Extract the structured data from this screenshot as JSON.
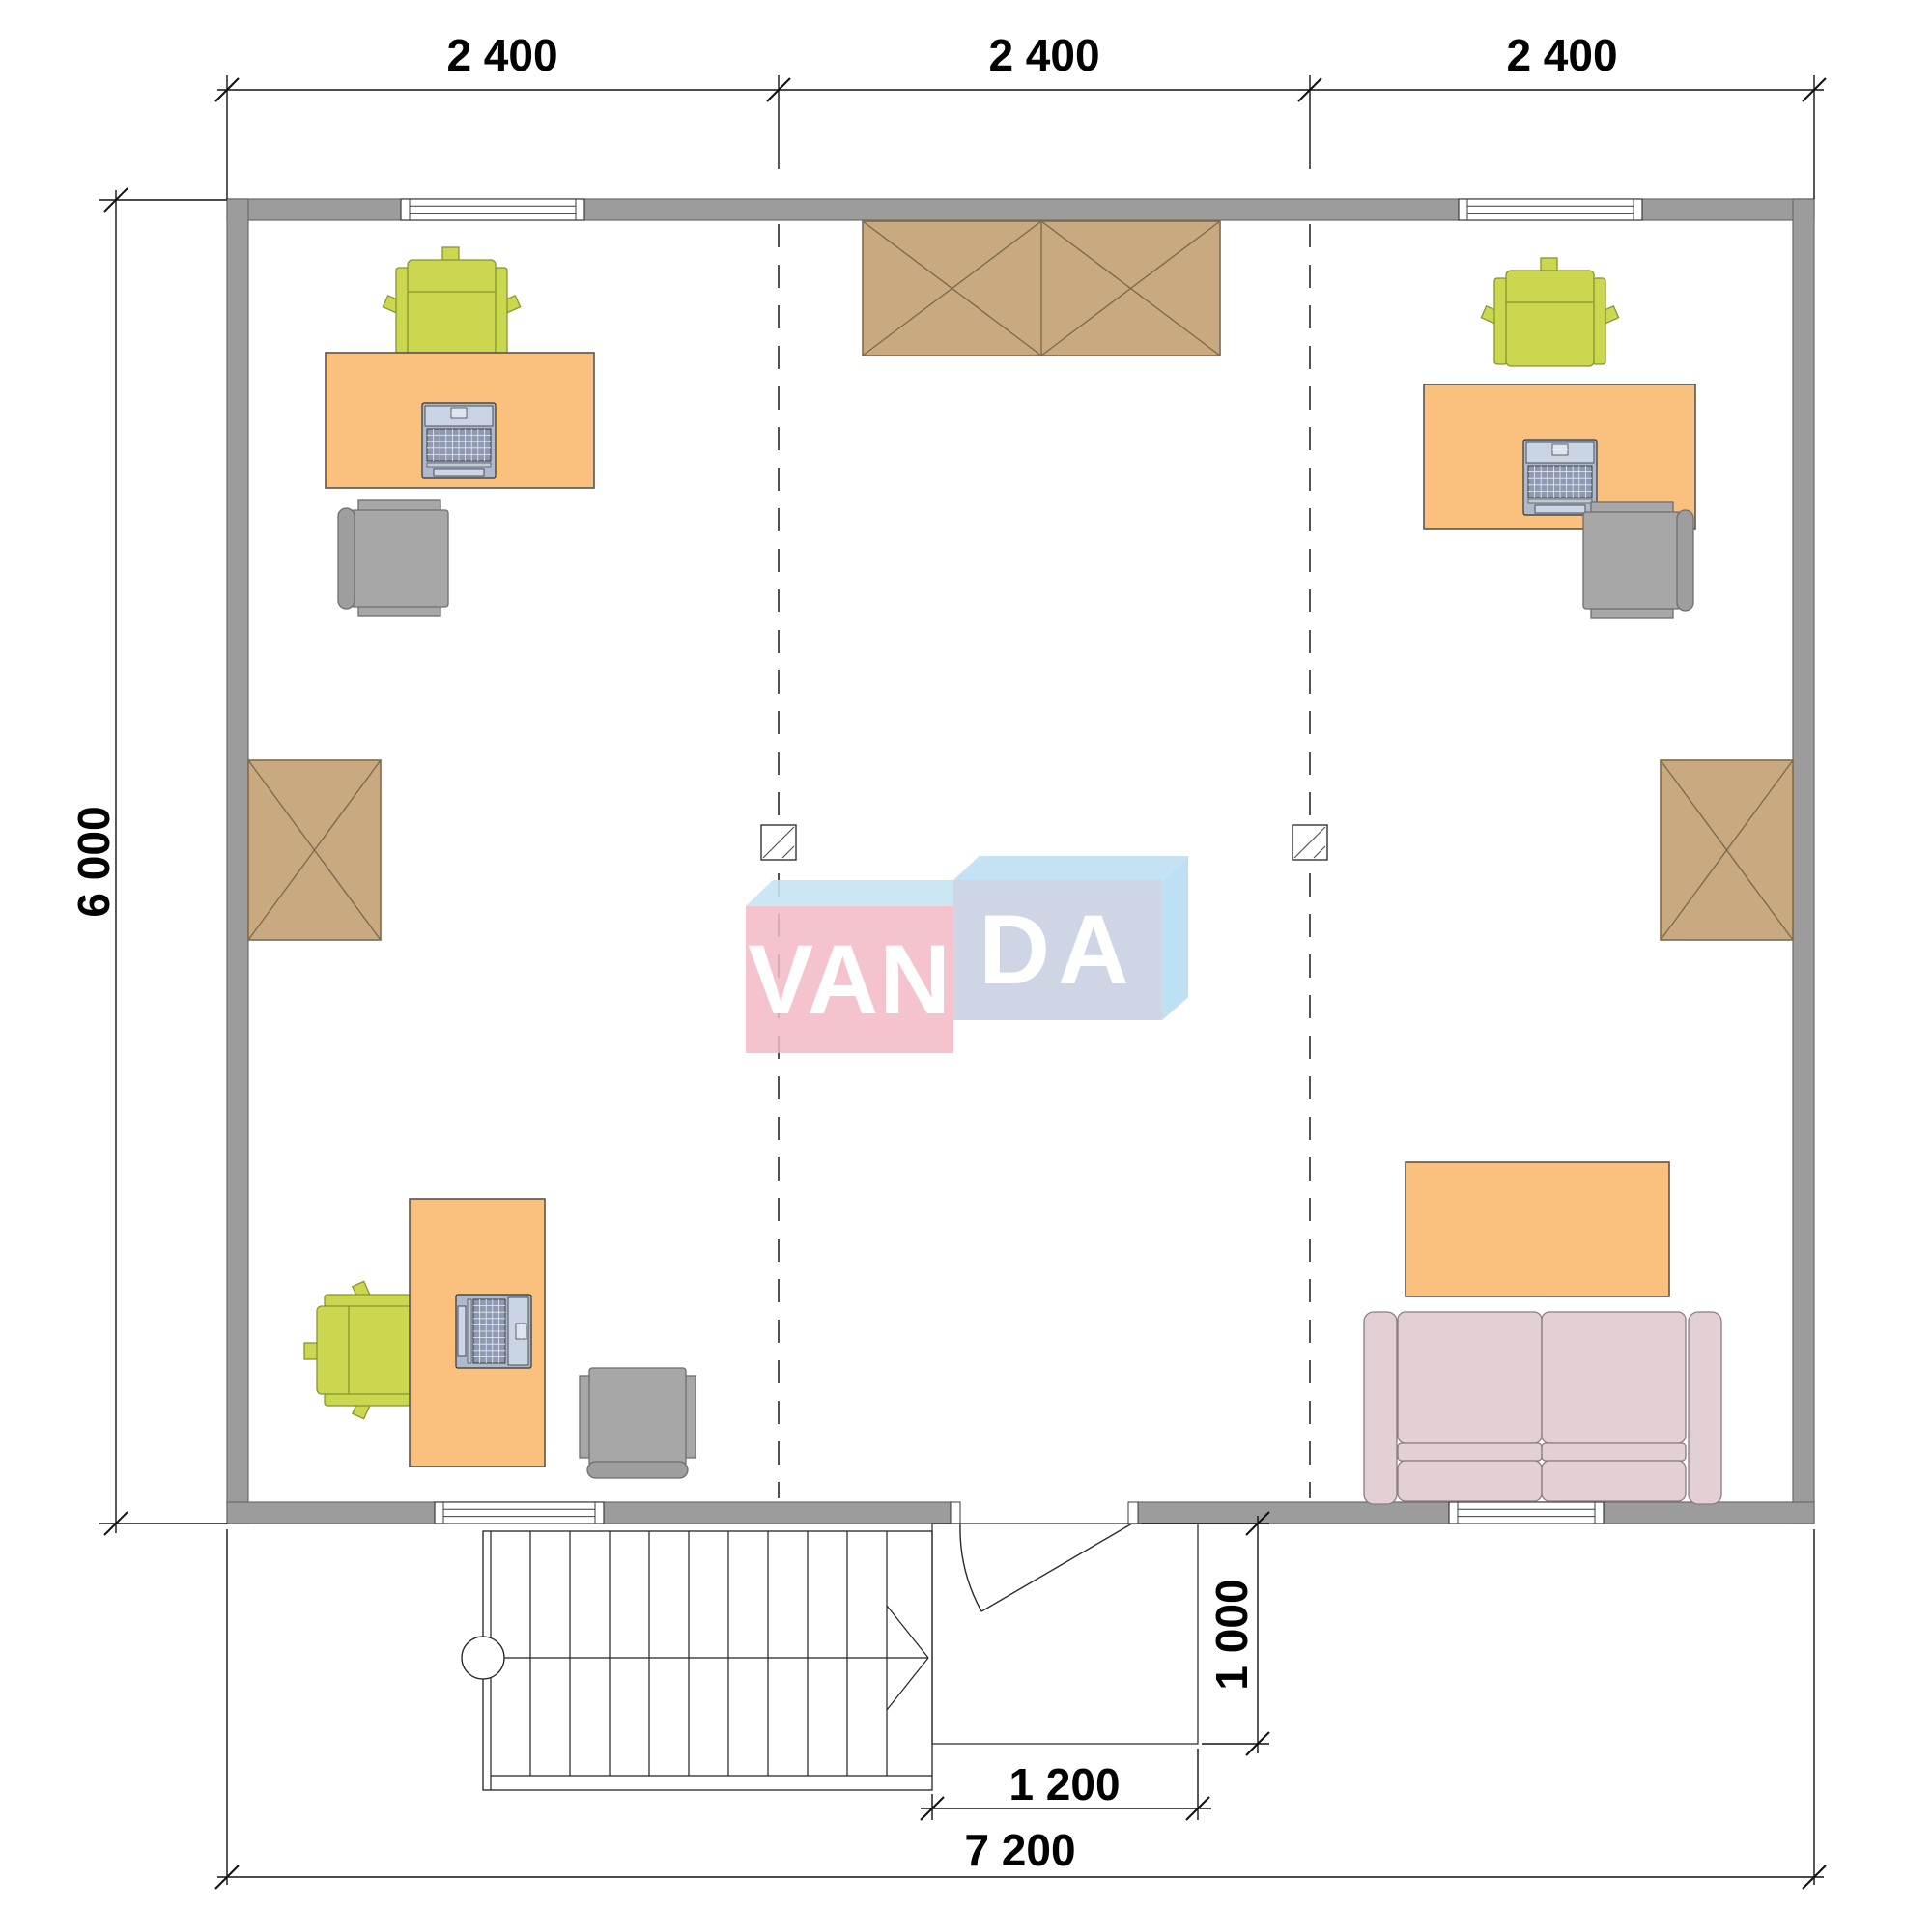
{
  "plan": {
    "watermark": {
      "left": "VAN",
      "right": "DA"
    },
    "dimensions": {
      "top": [
        "2 400",
        "2 400",
        "2 400"
      ],
      "left_total": "6 000",
      "bottom_total": "7 200",
      "entry_width": "1 200",
      "entry_depth": "1 000"
    }
  },
  "colors": {
    "wall": "#9c9c9c",
    "wall_border": "#6a6a6a",
    "desk": "#f9c07e",
    "desk_border": "#555555",
    "chair_green": "#ccd750",
    "chair_green_border": "#87942f",
    "chair_gray": "#a7a7a7",
    "chair_gray_back": "#9e9e9e",
    "chair_gray_border": "#6e6e6e",
    "wardrobe": "#c9a97f",
    "wardrobe_border": "#7d6b4e",
    "sofa": "#e2d0d4",
    "sofa_border": "#8d7b80",
    "laptop_body": "#aeb9cc",
    "line": "#111111",
    "text": "#000000",
    "logo_pink": "#f3b8c4",
    "logo_blue_top": "#bfdff2",
    "logo_blue_front": "#c5cfe0"
  }
}
